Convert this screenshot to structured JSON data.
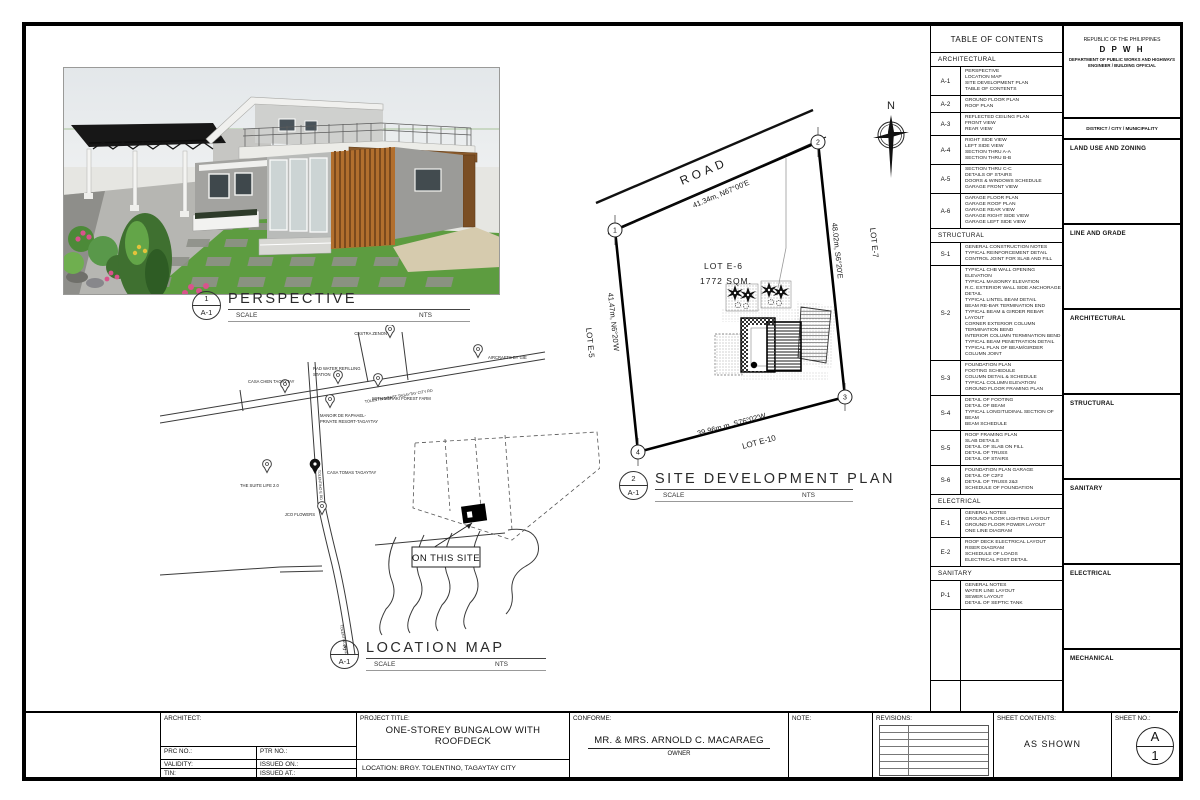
{
  "perspective": {
    "num": "1",
    "ref": "A-1",
    "title": "PERSPECTIVE",
    "scale_label": "SCALE",
    "scale_value": "NTS"
  },
  "site_plan": {
    "num": "2",
    "ref": "A-1",
    "title": "SITE DEVELOPMENT PLAN",
    "scale_label": "SCALE",
    "scale_value": "NTS",
    "north": "N",
    "road": "ROAD",
    "bearing_top": "41.34m, N67°00'E",
    "bearing_right": "48.02m, S6°20'E",
    "bearing_left": "41.47m, N6°20'W",
    "bearing_bottom": "39.96m m, S76°02'W",
    "lot_label": "LOT E-6",
    "lot_area": "1772 SQM.",
    "lot_right": "LOT E-7",
    "lot_left": "LOT E-5",
    "lot_bottom": "LOT E-10",
    "corner1": "1",
    "corner2": "2",
    "corner3": "3",
    "corner4": "4"
  },
  "location_map": {
    "num": "3",
    "ref": "A-1",
    "title": "LOCATION MAP",
    "scale_label": "SCALE",
    "scale_value": "NTS",
    "pins": {
      "castra_zenon": "CASTRA ZENON",
      "casa_chen": "CASA CHEN TAGAYTAY",
      "rad_water_1": "RAD WATER REFILLING",
      "rad_water_2": "STATION",
      "meraki": "WITH MERAKI FOREST FARM",
      "manoir_1": "MANOIR DE RAPHAEL-",
      "manoir_2": "PRIVATE RESORT-TAGAYTAY",
      "aircrafts": "AIRCRAFTS BY GIE",
      "casa_tomas": "CASA TOMAS TAGAYTAY",
      "suite_life": "THE SUITE LIFE 2.0",
      "jco": "JCO FLOWERS",
      "road_main": "TOLENTINO EAST TAGAYTAY CITY RD",
      "road_vert": "TOLENTINO E RD",
      "site_tag": "ON THIS SITE"
    }
  },
  "toc": {
    "title": "TABLE OF CONTENTS",
    "sections": [
      {
        "name": "ARCHITECTURAL",
        "rows": [
          {
            "code": "A-1",
            "items": [
              "PERSPECTIVE",
              "LOCATION MAP",
              "SITE DEVELOPMENT PLAN",
              "TABLE OF CONTENTS"
            ]
          },
          {
            "code": "A-2",
            "items": [
              "GROUND FLOOR PLAN",
              "ROOF PLAN"
            ]
          },
          {
            "code": "A-3",
            "items": [
              "REFLECTED CEILING PLAN",
              "FRONT VIEW",
              "REAR VIEW"
            ]
          },
          {
            "code": "A-4",
            "items": [
              "RIGHT SIDE VIEW",
              "LEFT SIDE VIEW",
              "SECTION THRU A-A",
              "SECTION THRU B-B"
            ]
          },
          {
            "code": "A-5",
            "items": [
              "SECTION THRU C-C",
              "DETAILS OF STAIRS",
              "DOORS & WINDOWS SCHEDULE",
              "GARAGE FRONT VIEW"
            ]
          },
          {
            "code": "A-6",
            "items": [
              "GARAGE FLOOR PLAN",
              "GARAGE ROOF PLAN",
              "GARAGE REAR VIEW",
              "GARAGE RIGHT SIDE VIEW",
              "GARAGE LEFT SIDE VIEW"
            ]
          }
        ]
      },
      {
        "name": "STRUCTURAL",
        "rows": [
          {
            "code": "S-1",
            "items": [
              "GENERAL CONSTRUCTION NOTES",
              "TYPICAL REINFORCEMENT DETAIL",
              "CONTROL JOINT FOR SLAB AND FILL"
            ]
          },
          {
            "code": "S-2",
            "items": [
              "TYPICAL CHB WALL OPENING ELEVATION",
              "TYPICAL MASONRY ELEVATION",
              "R.C. EXTERIOR WALL SIDE ANCHORAGE DETAIL",
              "TYPICAL LINTEL BEAM DETAIL",
              "BEAM RE-BAR TERMINATION END",
              "TYPICAL BEAM & GIRDER REBAR LAYOUT",
              "CORNER EXTERIOR COLUMN TERMINATION BEND",
              "INTERIOR COLUMN TERMINATION BEND",
              "TYPICAL BEAM PENETRATION DETAIL",
              "TYPICAL PLAN OF BEAM/GIRDER COLUMN JOINT"
            ]
          },
          {
            "code": "S-3",
            "items": [
              "FOUNDATION PLAN",
              "FOOTING SCHEDULE",
              "COLUMN DETAIL & SCHEDULE",
              "TYPICAL COLUMN ELEVATION",
              "GROUND FLOOR FRAMING PLAN"
            ]
          },
          {
            "code": "S-4",
            "items": [
              "DETAIL OF FOOTING",
              "DETAIL OF BEAM",
              "TYPICAL LONGITUDINAL SECTION OF BEAM",
              "BEAM SCHEDULE"
            ]
          },
          {
            "code": "S-5",
            "items": [
              "ROOF FRAMING PLAN",
              "SLAB DETAILS",
              "DETAIL OF SLAB ON FILL",
              "DETAIL OF TRUSS",
              "DETAIL OF STAIRS"
            ]
          },
          {
            "code": "S-6",
            "items": [
              "FOUNDATION PLAN GARAGE",
              "DETAIL OF C2F2",
              "DETAIL OF TRUSS 2&3",
              "SCHEDULE OF FOUNDATION"
            ]
          }
        ]
      },
      {
        "name": "ELECTRICAL",
        "rows": [
          {
            "code": "E-1",
            "items": [
              "GENERAL NOTES",
              "GROUND FLOOR LIGHTING LAYOUT",
              "GROUND FLOOR POWER LAYOUT",
              "ONE LINE DIAGRAM"
            ]
          },
          {
            "code": "E-2",
            "items": [
              "ROOF DECK ELECTRICAL LAYOUT",
              "RISER DIAGRAM",
              "SCHEDULE OF LOADS",
              "ELECTRICAL POST DETAIL"
            ]
          }
        ]
      },
      {
        "name": "SANITARY",
        "rows": [
          {
            "code": "P-1",
            "items": [
              "GENERAL NOTES",
              "WATER LINE LAYOUT",
              "SEWER LAYOUT",
              "DETAIL OF SEPTIC TANK"
            ]
          }
        ]
      }
    ]
  },
  "agency": {
    "line1": "REPUBLIC OF THE PHILIPPINES",
    "line2": "D P W H",
    "line3": "DEPARTMENT OF PUBLIC WORKS AND HIGHWAYS",
    "line4": "ENGINEER / BUILDING OFFICIAL",
    "district": "DISTRICT / CITY / MUNICIPALITY",
    "boxes": [
      "LAND USE AND ZONING",
      "LINE AND GRADE",
      "ARCHITECTURAL",
      "STRUCTURAL",
      "SANITARY",
      "ELECTRICAL",
      "MECHANICAL"
    ]
  },
  "titleblock": {
    "architect_label": "ARCHITECT:",
    "prc": "PRC NO.:",
    "ptr": "PTR NO.:",
    "validity": "VALIDITY:",
    "issued_on": "ISSUED ON.:",
    "tin": "TIN:",
    "issued_at": "ISSUED AT.:",
    "project_title_label": "PROJECT TITLE:",
    "project_title_line1": "ONE-STOREY BUNGALOW WITH",
    "project_title_line2": "ROOFDECK",
    "location": "LOCATION: BRGY. TOLENTINO, TAGAYTAY CITY",
    "conforme_label": "CONFORME:",
    "owner_name": "MR. & MRS. ARNOLD C. MACARAEG",
    "owner_role": "OWNER",
    "note_label": "NOTE:",
    "revisions_label": "REVISIONS:",
    "sheet_contents_label": "SHEET CONTENTS:",
    "sheet_contents_value": "AS SHOWN",
    "sheet_no_label": "SHEET NO.:",
    "sheet_no_top": "A",
    "sheet_no_bottom": "1"
  }
}
